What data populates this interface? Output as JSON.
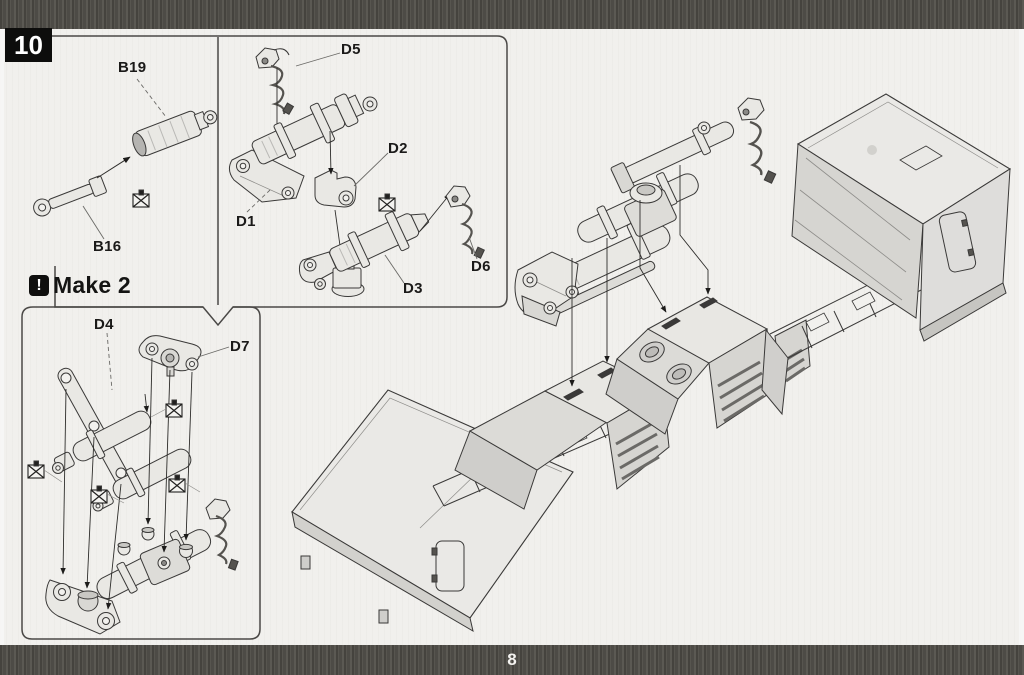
{
  "page": {
    "step_number": "10",
    "page_number": "8",
    "assembly_note": {
      "icon": "attention-icon",
      "icon_glyph": "!",
      "text": "Make 2"
    }
  },
  "part_labels": {
    "b19": "B19",
    "b16": "B16",
    "d1": "D1",
    "d2": "D2",
    "d3": "D3",
    "d4": "D4",
    "d5": "D5",
    "d6": "D6",
    "d7": "D7"
  },
  "symbols": {
    "do_not_cement_glyph": "☒",
    "do_not_cement_count": 6
  },
  "colors": {
    "paper": "#f1f0ed",
    "band": "#4d4b46",
    "badge_bg": "#0d0d0c",
    "badge_text": "#ffffff",
    "line": "#3a3938",
    "part_fill": "#e9e8e4",
    "part_shade": "#d6d5d1"
  }
}
